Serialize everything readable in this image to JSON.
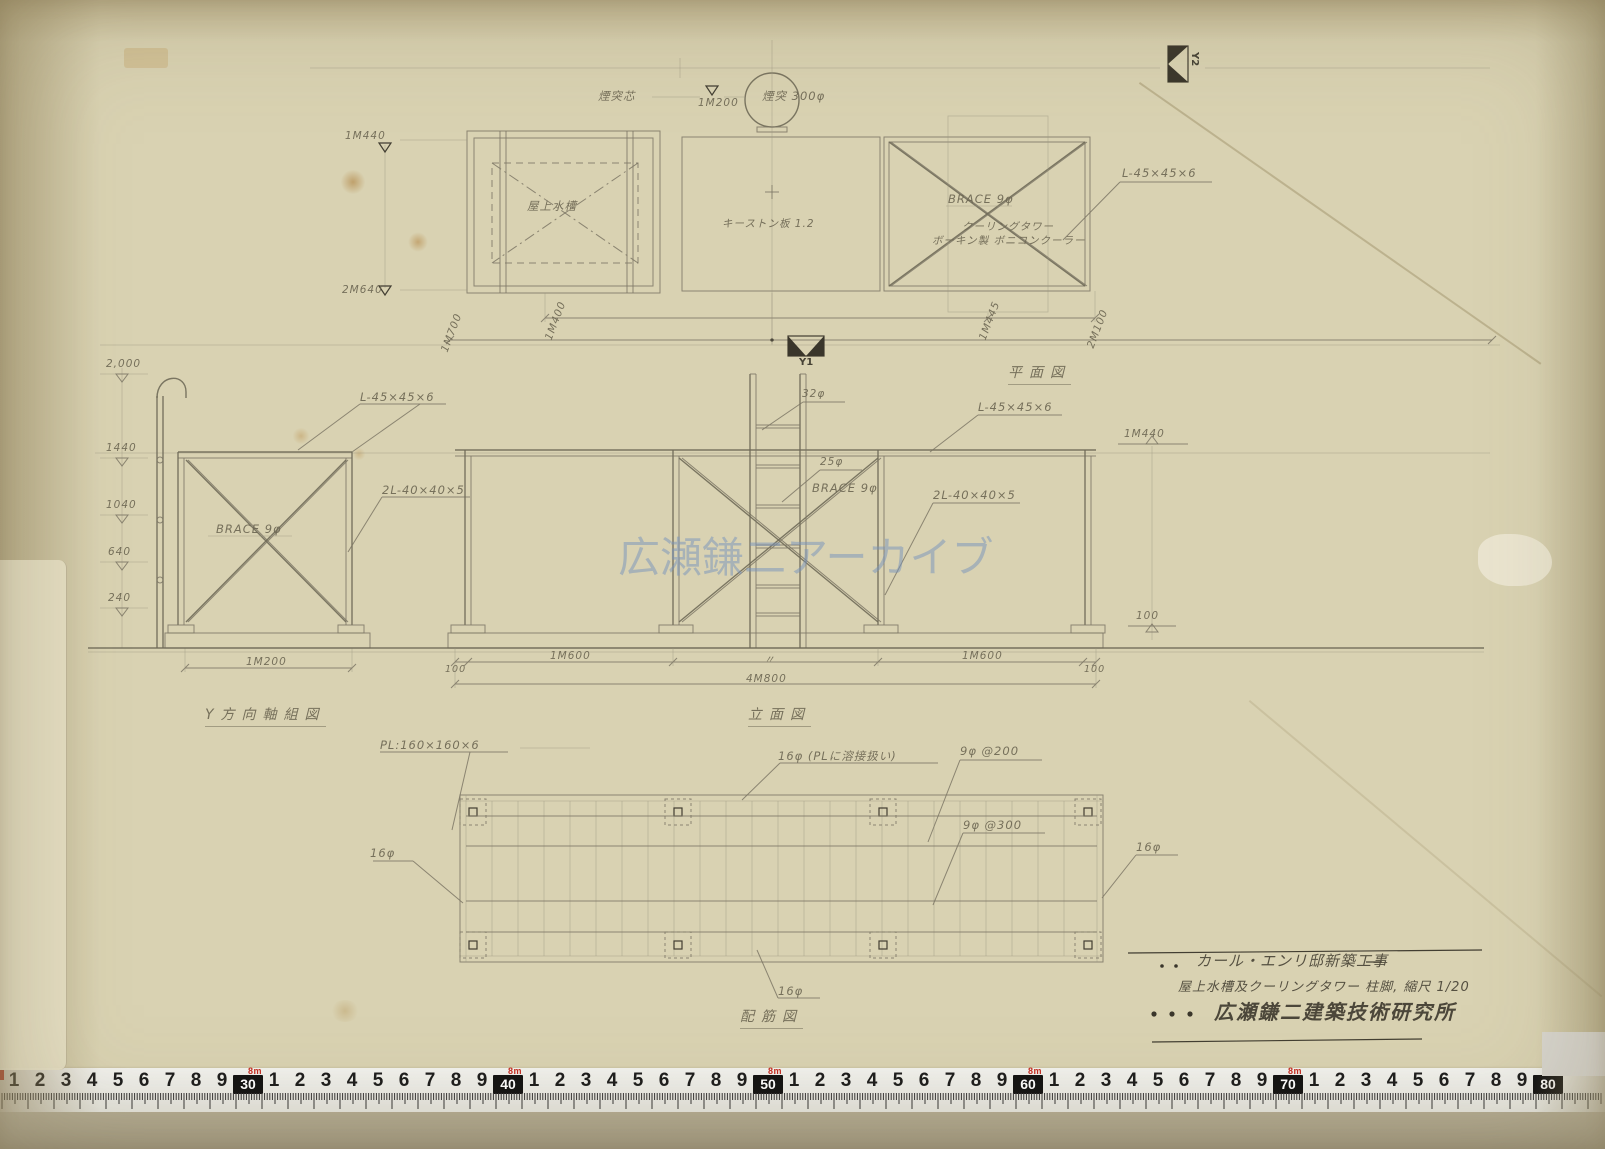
{
  "watermark": "広瀬鎌二アーカイブ",
  "plan": {
    "title": "平面図",
    "chimney_center": "煙突芯",
    "level_1m200": "1M200",
    "chimney": "煙突 300φ",
    "tank": "屋上水槽",
    "keystone": "キーストン板 1.2",
    "brace": "BRACE 9φ",
    "cooling_line1": "クーリングタワー",
    "cooling_line2": "ボーキン製 ボニコンクーラー",
    "angle": "L-45×45×6",
    "lv_top": "1M440",
    "lv_bottom": "2M640",
    "d1": "1M700",
    "d2": "1M400",
    "d3": "1M445",
    "d4": "2M100",
    "y1": "Y1",
    "y2": "Y2"
  },
  "yframe": {
    "title": "Y方向軸組図",
    "levels": [
      "2,000",
      "1440",
      "1040",
      "640",
      "240"
    ],
    "angle": "L-45×45×6",
    "brace": "BRACE 9φ",
    "dangle": "2L-40×40×5",
    "dim": "1M200"
  },
  "elev": {
    "title": "立面図",
    "p32": "32φ",
    "p25": "25φ",
    "brace": "BRACE 9φ",
    "angle": "L-45×45×6",
    "dangle": "2L-40×40×5",
    "lv440": "1M440",
    "lv100": "100",
    "d100l": "100",
    "d1600l": "1M600",
    "ditto": "〃",
    "d1600r": "1M600",
    "d100r": "100",
    "total": "4M800"
  },
  "rebar": {
    "title": "配筋図",
    "plate": "PL:160×160×6",
    "bar16_weld": "16φ (PLに溶接扱い)",
    "bar9_200": "9φ @200",
    "bar9_300": "9φ @300",
    "bar16": "16φ"
  },
  "titleblock": {
    "line1": "カール・エンリ邸新築工事",
    "line2": "屋上水槽及クーリングタワー 柱脚, 縮尺 1/20",
    "line3": "広瀬鎌二建築技術研究所"
  },
  "ruler": {
    "unit_label": "8m",
    "majors": [
      "30",
      "40",
      "50",
      "60",
      "70",
      "80"
    ],
    "minors": [
      "1",
      "2",
      "3",
      "4",
      "5",
      "6",
      "7",
      "8",
      "9"
    ]
  },
  "colors": {
    "paper": "#d9d2b2",
    "pencil": "#6e6854",
    "line": "#7d7765",
    "watermark": "rgba(118,146,188,0.5)",
    "ruler_red": "#c42a1e",
    "marker": "#3a362b"
  }
}
